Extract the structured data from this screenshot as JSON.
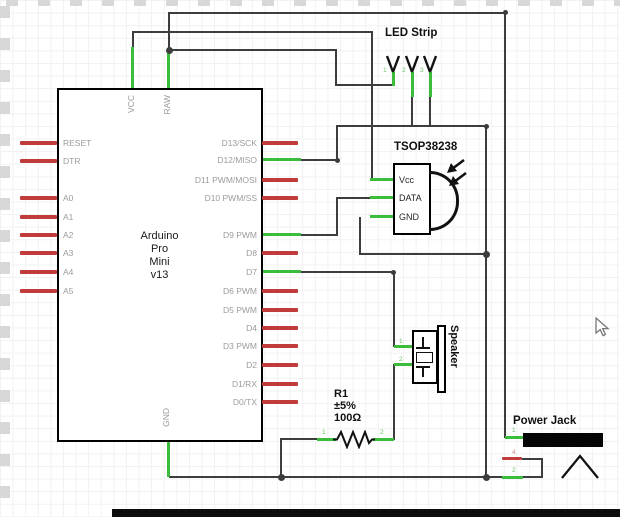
{
  "arduino": {
    "name_lines": [
      "Arduino",
      "Pro",
      "Mini",
      "v13"
    ],
    "top_pins": [
      "VCC",
      "RAW"
    ],
    "bottom_pin": "GND",
    "left_pins": [
      "RESET",
      "DTR",
      "A0",
      "A1",
      "A2",
      "A3",
      "A4",
      "A5"
    ],
    "right_pins": [
      "D13/SCK",
      "D12/MISO",
      "D11 PWM/MOSI",
      "D10 PWM/SS",
      "D9 PWM",
      "D8",
      "D7",
      "D6 PWM",
      "D5 PWM",
      "D4",
      "D3 PWM",
      "D2",
      "D1/RX",
      "D0/TX"
    ]
  },
  "led_strip": {
    "label": "LED Strip",
    "pin_numbers": [
      "1",
      "2",
      "3"
    ]
  },
  "tsop": {
    "label": "TSOP38238",
    "pins": [
      "Vcc",
      "DATA",
      "GND"
    ]
  },
  "speaker": {
    "label": "Speaker",
    "pin_numbers": [
      "1",
      "2"
    ]
  },
  "resistor": {
    "designator": "R1",
    "tolerance": "±5%",
    "value": "100Ω",
    "pin_numbers": [
      "1",
      "2"
    ]
  },
  "power_jack": {
    "label": "Power Jack",
    "pin_numbers": [
      "1",
      "4",
      "2"
    ]
  },
  "colors": {
    "wire": "#3d3d3d",
    "routed_wire": "#3cbc3c",
    "unrouted_pin": "#c23b3b",
    "pin_label": "#9b9b9b",
    "component_outline": "#000000",
    "background": "#ffffff",
    "grid": "#f1f1f1"
  }
}
